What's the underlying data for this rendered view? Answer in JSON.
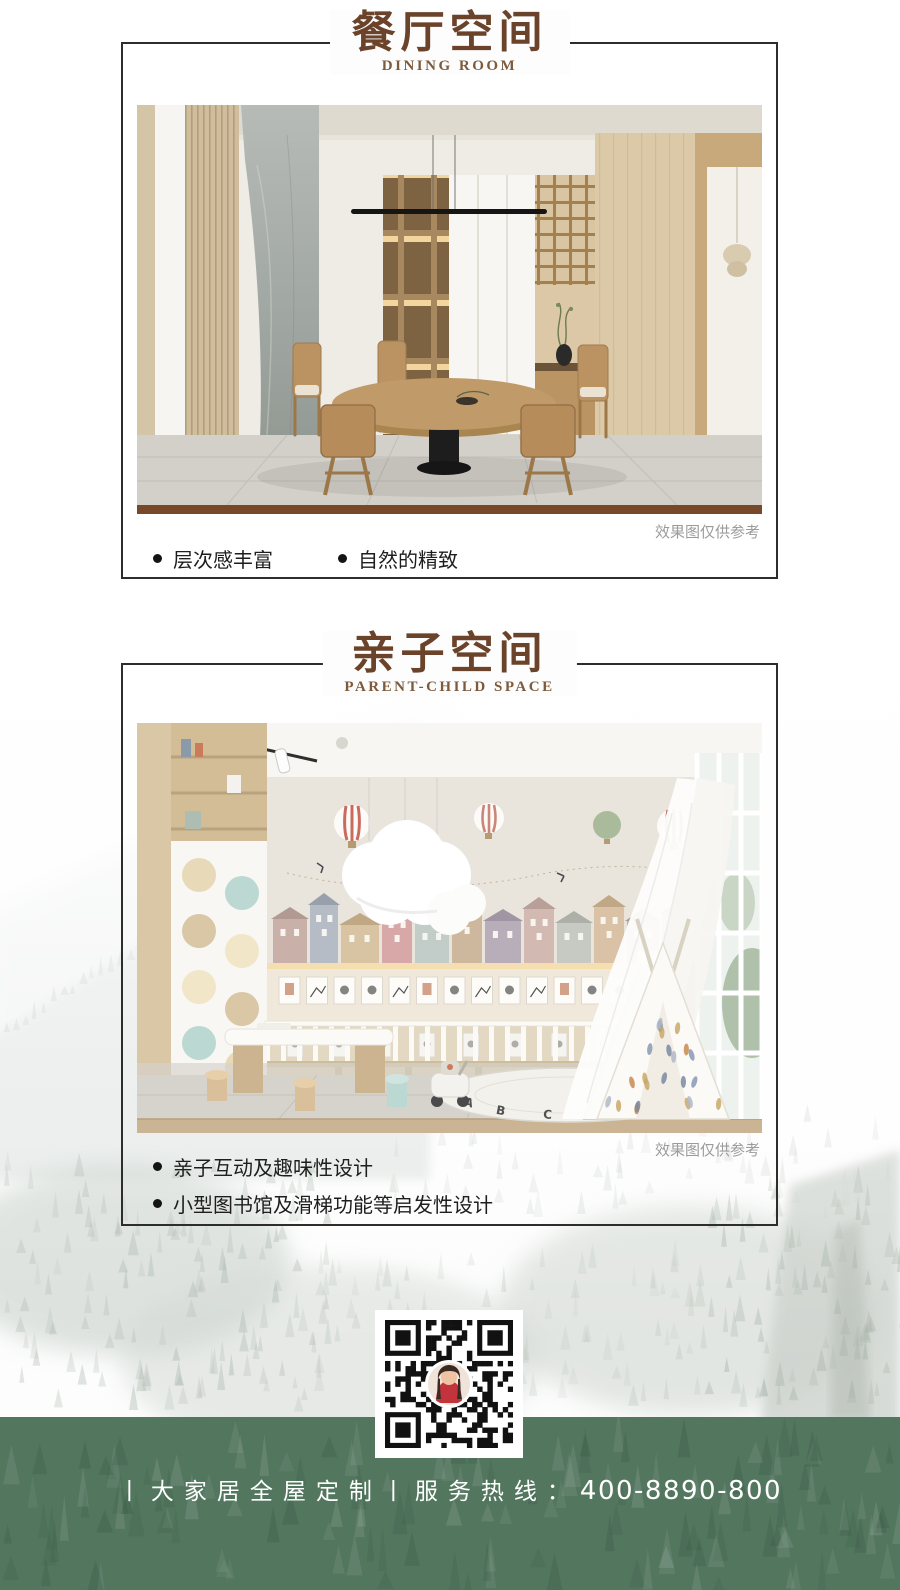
{
  "sections": [
    {
      "title": "餐厅空间",
      "subtitle": "DINING ROOM",
      "caption": "效果图仅供参考",
      "bullets": [
        "层次感丰富",
        "自然的精致"
      ]
    },
    {
      "title": "亲子空间",
      "subtitle": "PARENT-CHILD SPACE",
      "caption": "效果图仅供参考",
      "bullets": [
        "亲子互动及趣味性设计",
        "小型图书馆及滑梯功能等启发性设计"
      ]
    }
  ],
  "photos": {
    "kids_rug_letters": "ABCDE"
  },
  "footer": {
    "label": "丨大家居全屋定制丨服务热线：",
    "number": "400-8890-800"
  },
  "colors": {
    "title_brown": "#6b432a",
    "accent_bar": "#76492b",
    "footer_green": "#53765f",
    "frame_border": "#2e2d2b",
    "caption_gray": "#9b9b9b"
  }
}
